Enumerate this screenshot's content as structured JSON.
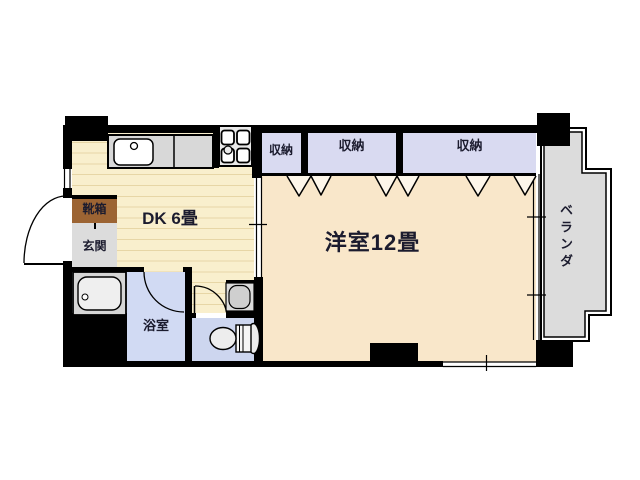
{
  "rooms": {
    "dining_kitchen": {
      "label": "DK 6畳"
    },
    "western_room": {
      "label": "洋室12畳"
    },
    "closets": [
      {
        "label": "収納"
      },
      {
        "label": "収納"
      },
      {
        "label": "収納"
      }
    ],
    "entrance": {
      "label": "玄関"
    },
    "shoe_box": {
      "label": "靴箱"
    },
    "bathroom": {
      "label": "浴室"
    },
    "veranda": {
      "label": "ベランダ"
    }
  },
  "colors": {
    "wall": "#000000",
    "dk_floor": "#f9efcd",
    "dk_stripe": "#e7d6a6",
    "western_room_floor": "#f9e7ca",
    "closet_floor": "#d9daf1",
    "bathroom_floor": "#d1daf3",
    "toilet_floor": "#cdd6ef",
    "entrance_floor": "#dcdcdc",
    "shoe_box": "#9c6433",
    "veranda_floor": "#dcdcdc",
    "fixture_gray": "#d8d8d8",
    "label_text": "#1b1b2e"
  }
}
